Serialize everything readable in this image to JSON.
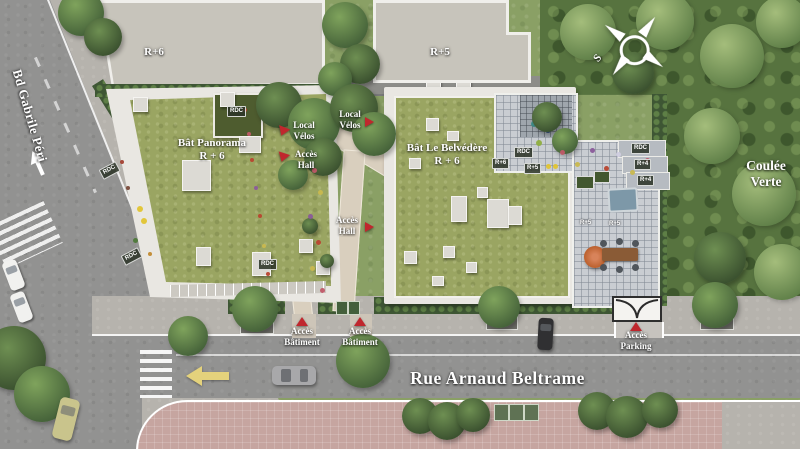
{
  "streets": {
    "left_street": "Bd Gabrile Péri",
    "bottom_street": "Rue Arnaud Beltrame"
  },
  "context_buildings": {
    "top_left_level": "R+6",
    "top_right_level": "R+5"
  },
  "buildings": {
    "panorama": {
      "name": "Bât Panorama",
      "level": "R + 6",
      "roof_box": "RDC"
    },
    "belvedere": {
      "name": "Bât Le Belvédère",
      "level": "R + 6"
    }
  },
  "green_space": {
    "name_line1": "Coulée",
    "name_line2": "Verte"
  },
  "access": {
    "local_velos_west": {
      "line1": "Local",
      "line2": "Vélos"
    },
    "local_velos_east": {
      "line1": "Local",
      "line2": "Vélos"
    },
    "hall_west": {
      "line1": "Accès",
      "line2": "Hall"
    },
    "hall_east": {
      "line1": "Accès",
      "line2": "Hall"
    },
    "batiment_west": {
      "line1": "Accès",
      "line2": "Bâtiment"
    },
    "batiment_east": {
      "line1": "Accès",
      "line2": "Bâtiment"
    },
    "parking": {
      "line1": "Accès",
      "line2": "Parking"
    }
  },
  "level_badges": {
    "panorama_west_upper": "RDC",
    "panorama_west_lower": "RDC",
    "panorama_south": "RDC",
    "belvedere_rdc": "RDC",
    "belvedere_r6": "R+6",
    "belvedere_r5": "R+5",
    "wing_rdc": "RDC",
    "wing_r4_upper": "R+4",
    "wing_r4_lower": "R+4",
    "terrace_r5_west": "R+5",
    "terrace_r5_east": "R+5"
  },
  "compass": {
    "south_label": "S"
  },
  "colors": {
    "marker_red": "#c0272d",
    "road_gray": "#929291",
    "sidewalk_gray": "#b6b3ad",
    "pink_pavement": "#c6a5a0",
    "green_roof": "#9aa562",
    "forest_green": "#57733f",
    "lawn_green": "#8aa065",
    "building_gray": "#c7c4bb",
    "arrow_yellow": "#e4d27c"
  }
}
